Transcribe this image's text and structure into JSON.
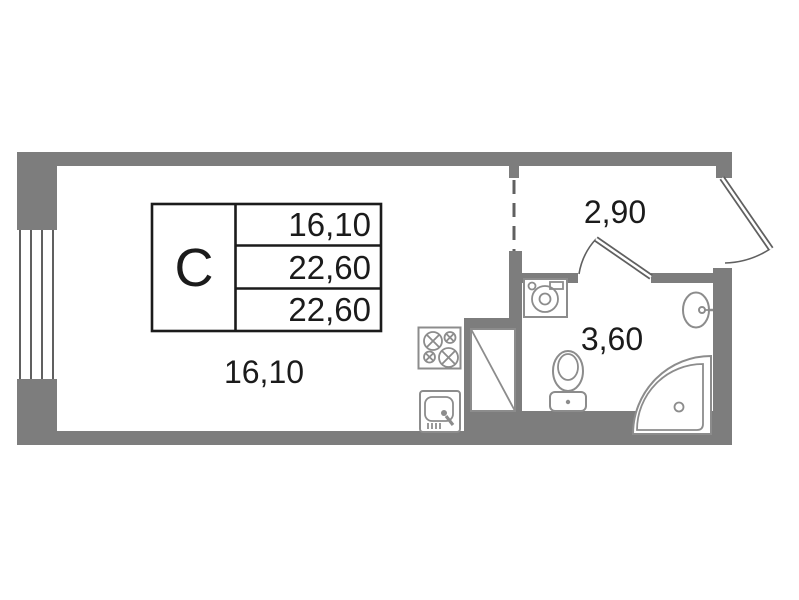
{
  "colors": {
    "bg": "#ffffff",
    "wall": "#7d7d7d",
    "fixture": "#8c8c8c",
    "line": "#606060",
    "text": "#1b1b1b"
  },
  "spec_table": {
    "unit_type": "С",
    "values": [
      "16,10",
      "22,60",
      "22,60"
    ]
  },
  "rooms": {
    "living": {
      "area": "16,10"
    },
    "hallway": {
      "area": "2,90"
    },
    "bathroom": {
      "area": "3,60"
    }
  },
  "fixtures": {
    "kitchen": [
      "stove-icon",
      "kitchen-sink-icon"
    ],
    "bathroom": [
      "washing-machine-icon",
      "toilet-icon",
      "wash-basin-icon",
      "shower-cabin-icon"
    ],
    "doors": [
      "entrance-door",
      "interior-door"
    ],
    "other": [
      "window",
      "ventilation-shaft",
      "zone-divider-dashed"
    ]
  }
}
